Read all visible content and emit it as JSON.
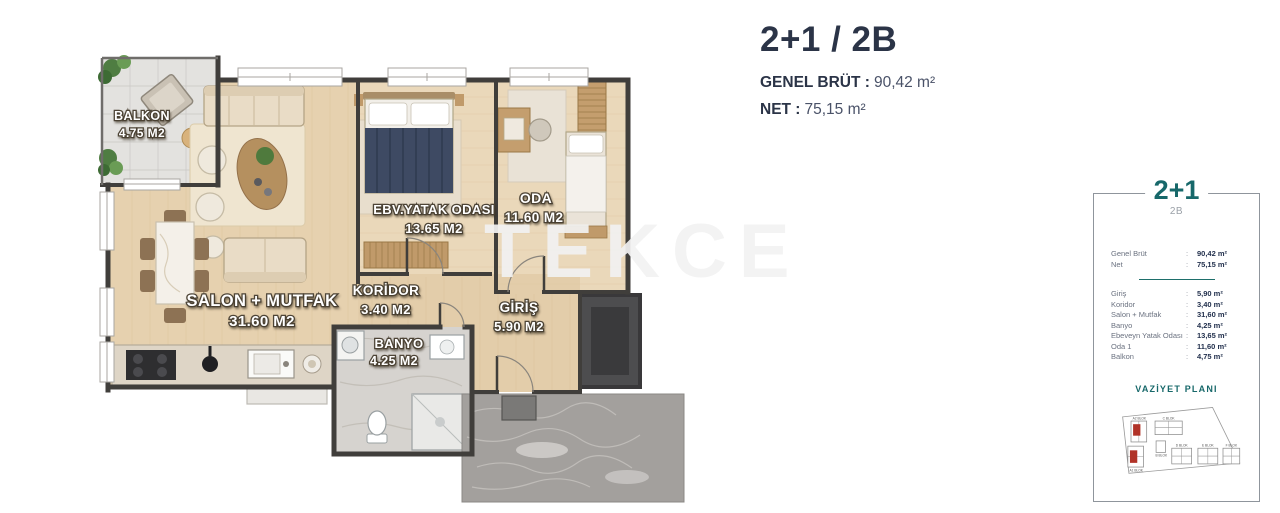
{
  "header": {
    "title": "2+1 / 2B",
    "gross_label": "GENEL BRÜT :",
    "gross_value": "90,42 m²",
    "net_label": "NET :",
    "net_value": "75,15 m²"
  },
  "watermark": "TEKCE",
  "floor_plan": {
    "rooms": [
      {
        "name": "BALKON",
        "area": "4.75 M2"
      },
      {
        "name": "SALON + MUTFAK",
        "area": "31.60 M2"
      },
      {
        "name": "KORİDOR",
        "area": "3.40 M2"
      },
      {
        "name": "BANYO",
        "area": "4.25 M2"
      },
      {
        "name": "GİRİŞ",
        "area": "5.90 M2"
      },
      {
        "name": "EBV.YATAK ODASI",
        "area": "13.65 M2"
      },
      {
        "name": "ODA",
        "area": "11.60 M2"
      }
    ]
  },
  "card": {
    "title": "2+1",
    "subtitle": "2B",
    "colon": ":",
    "summary": [
      {
        "label": "Genel Brüt",
        "value": "90,42 m²"
      },
      {
        "label": "Net",
        "value": "75,15 m²"
      }
    ],
    "rooms": [
      {
        "label": "Giriş",
        "value": "5,90 m²"
      },
      {
        "label": "Koridor",
        "value": "3,40 m²"
      },
      {
        "label": "Salon + Mutfak",
        "value": "31,60 m²"
      },
      {
        "label": "Banyo",
        "value": "4,25 m²"
      },
      {
        "label": "Ebeveyn Yatak Odası",
        "value": "13,65 m²"
      },
      {
        "label": "Oda 1",
        "value": "11,60 m²"
      },
      {
        "label": "Balkon",
        "value": "4,75 m²"
      }
    ],
    "site_plan_title": "VAZİYET PLANI",
    "site_blocks": [
      "A2 BLOK",
      "A1 BLOK",
      "B BLOK",
      "C BLOK",
      "D BLOK",
      "E BLOK",
      "F BLOK"
    ],
    "accent_color": "#17686a",
    "highlight_color": "#b13328"
  }
}
